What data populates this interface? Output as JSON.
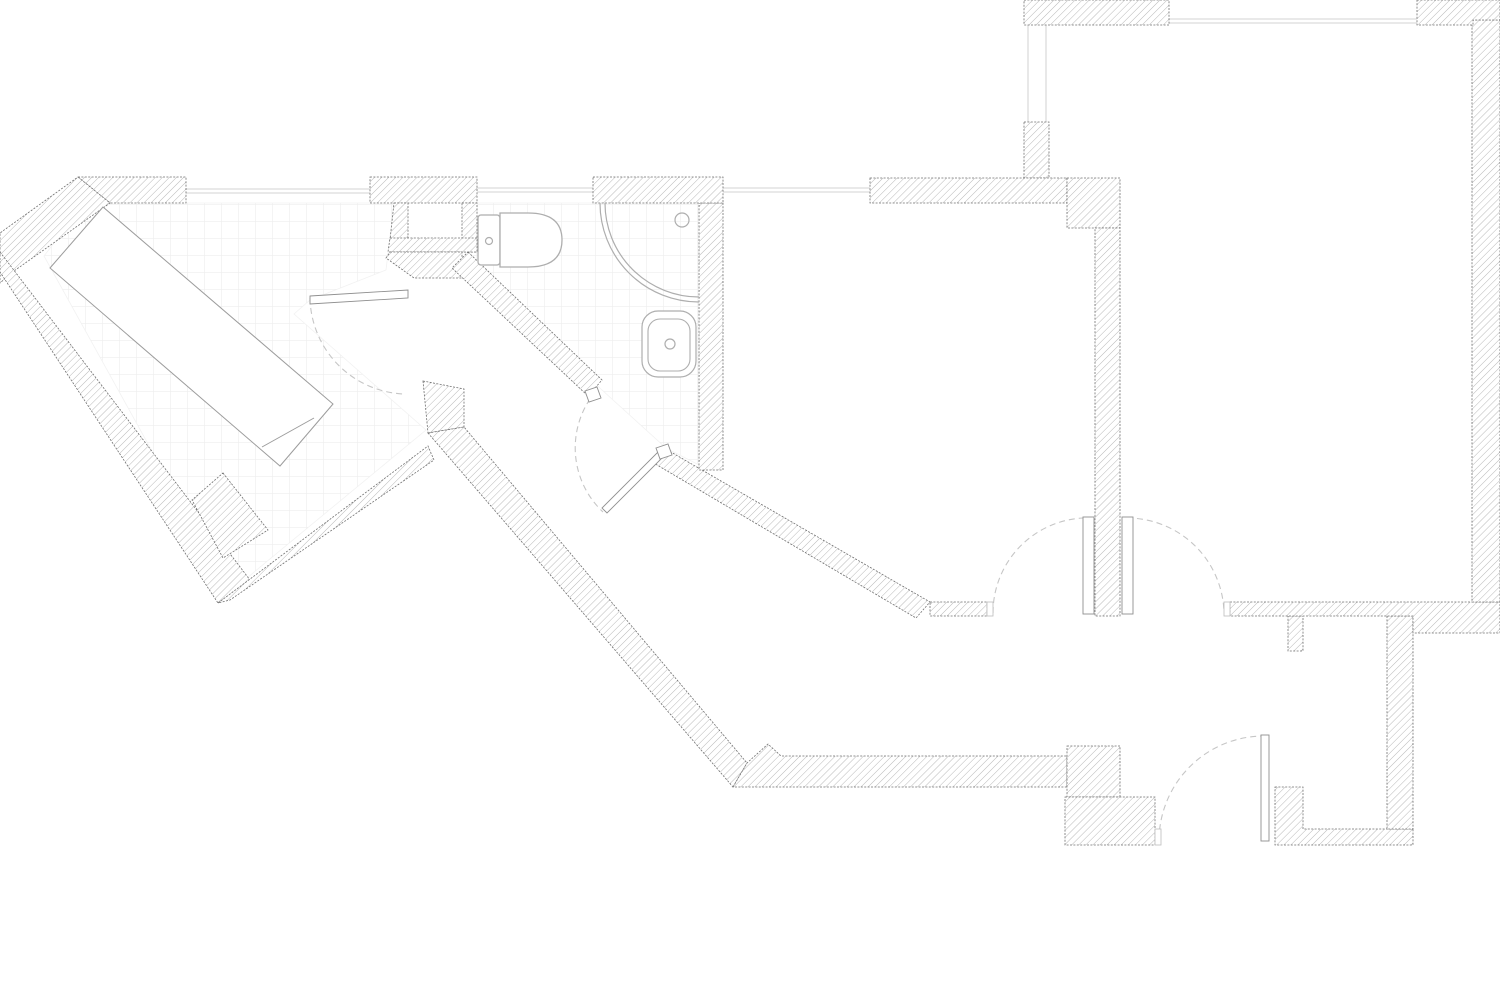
{
  "drawing": {
    "type": "architectural-floor-plan",
    "canvas": {
      "width": 1500,
      "height": 983,
      "background": "#ffffff"
    },
    "style": {
      "wall_hatch_color": "#b9b9b9",
      "wall_outline_color": "#707070",
      "tile_line_color": "#ededed",
      "tile_size": 17,
      "fixture_stroke": "#aeaeae",
      "furniture_stroke": "#9c9c9c",
      "window_color": "#e2e2e2",
      "door_arc_color": "#c6c6c6",
      "leaf_stroke": "#8f8f8f"
    },
    "tile_areas": [
      {
        "name": "entry-room-floor-tiles",
        "points": [
          [
            108,
            203
          ],
          [
            394,
            203
          ],
          [
            386,
            270
          ],
          [
            310,
            300
          ],
          [
            294,
            314
          ],
          [
            426,
            430
          ],
          [
            230,
            592
          ],
          [
            44,
            256
          ],
          [
            84,
            204
          ]
        ]
      },
      {
        "name": "bathroom-floor-tiles",
        "points": [
          [
            477,
            203
          ],
          [
            699,
            203
          ],
          [
            699,
            465
          ],
          [
            666,
            448
          ],
          [
            602,
            390
          ],
          [
            470,
            266
          ],
          [
            470,
            252
          ],
          [
            477,
            252
          ]
        ]
      }
    ],
    "walls": [
      {
        "name": "top-left-room-top-wall",
        "points": [
          [
            78,
            177
          ],
          [
            186,
            177
          ],
          [
            186,
            203
          ],
          [
            110,
            203
          ]
        ]
      },
      {
        "name": "northwest-diagonal-wall",
        "points": [
          [
            78,
            177
          ],
          [
            110,
            203
          ],
          [
            14,
            271
          ],
          [
            0,
            283
          ],
          [
            0,
            233
          ]
        ]
      },
      {
        "name": "southwest-outer-wall",
        "points": [
          [
            0,
            252
          ],
          [
            250,
            580
          ],
          [
            218,
            603
          ],
          [
            0,
            272
          ]
        ]
      },
      {
        "name": "v-notch-wall",
        "points": [
          [
            218,
            603
          ],
          [
            428,
            446
          ],
          [
            434,
            460
          ],
          [
            230,
            600
          ]
        ]
      },
      {
        "name": "corridor-door-block",
        "points": [
          [
            423,
            381
          ],
          [
            464,
            389
          ],
          [
            464,
            427
          ],
          [
            428,
            433
          ]
        ]
      },
      {
        "name": "corridor-southwest-wall",
        "points": [
          [
            428,
            433
          ],
          [
            464,
            427
          ],
          [
            747,
            763
          ],
          [
            733,
            787
          ]
        ]
      },
      {
        "name": "bottom-hall-wall",
        "points": [
          [
            733,
            787
          ],
          [
            747,
            763
          ],
          [
            768,
            744
          ],
          [
            781,
            756
          ],
          [
            1067,
            756
          ],
          [
            1067,
            787
          ]
        ]
      },
      {
        "name": "hall-step-block",
        "points": [
          [
            1067,
            746
          ],
          [
            1120,
            746
          ],
          [
            1120,
            797
          ],
          [
            1067,
            797
          ]
        ]
      },
      {
        "name": "hall-lower-block",
        "points": [
          [
            1065,
            797
          ],
          [
            1155,
            797
          ],
          [
            1155,
            845
          ],
          [
            1065,
            845
          ]
        ]
      },
      {
        "name": "entry-corner-wall",
        "points": [
          [
            1275,
            787
          ],
          [
            1303,
            787
          ],
          [
            1303,
            829
          ],
          [
            1413,
            829
          ],
          [
            1413,
            845
          ],
          [
            1275,
            845
          ]
        ]
      },
      {
        "name": "nook-right-wall",
        "points": [
          [
            1387,
            616
          ],
          [
            1413,
            616
          ],
          [
            1413,
            829
          ],
          [
            1387,
            829
          ]
        ]
      },
      {
        "name": "nook-top-stub",
        "points": [
          [
            1288,
            616
          ],
          [
            1303,
            616
          ],
          [
            1303,
            651
          ],
          [
            1288,
            651
          ]
        ]
      },
      {
        "name": "bottomright-top-wall",
        "points": [
          [
            1230,
            602
          ],
          [
            1500,
            602
          ],
          [
            1500,
            633
          ],
          [
            1413,
            633
          ],
          [
            1413,
            616
          ],
          [
            1230,
            616
          ]
        ]
      },
      {
        "name": "right-outer-wall",
        "points": [
          [
            1472,
            20
          ],
          [
            1500,
            20
          ],
          [
            1500,
            602
          ],
          [
            1472,
            602
          ]
        ]
      },
      {
        "name": "topright-corner-wall",
        "points": [
          [
            1417,
            0
          ],
          [
            1500,
            0
          ],
          [
            1500,
            20
          ],
          [
            1473,
            20
          ],
          [
            1473,
            25
          ],
          [
            1417,
            25
          ]
        ]
      },
      {
        "name": "bedroom-top-wall",
        "points": [
          [
            1024,
            0
          ],
          [
            1169,
            0
          ],
          [
            1169,
            25
          ],
          [
            1024,
            25
          ]
        ]
      },
      {
        "name": "window-stub-wall",
        "points": [
          [
            1024,
            122
          ],
          [
            1049,
            122
          ],
          [
            1049,
            178
          ],
          [
            1024,
            178
          ]
        ]
      },
      {
        "name": "living-top-wall",
        "points": [
          [
            870,
            178
          ],
          [
            1067,
            178
          ],
          [
            1067,
            203
          ],
          [
            870,
            203
          ]
        ]
      },
      {
        "name": "living-corner-block",
        "points": [
          [
            1067,
            178
          ],
          [
            1120,
            178
          ],
          [
            1120,
            228
          ],
          [
            1067,
            228
          ]
        ]
      },
      {
        "name": "room-divider-wall",
        "points": [
          [
            1095,
            228
          ],
          [
            1120,
            228
          ],
          [
            1120,
            616
          ],
          [
            1095,
            616
          ]
        ]
      },
      {
        "name": "living-bottom-wall",
        "points": [
          [
            930,
            602
          ],
          [
            987,
            602
          ],
          [
            987,
            616
          ],
          [
            930,
            616
          ]
        ]
      },
      {
        "name": "living-southwest-wall",
        "points": [
          [
            664,
            448
          ],
          [
            930,
            602
          ],
          [
            916,
            618
          ],
          [
            652,
            462
          ]
        ]
      },
      {
        "name": "bathroom-right-wall",
        "points": [
          [
            699,
            203
          ],
          [
            723,
            203
          ],
          [
            723,
            470
          ],
          [
            699,
            470
          ]
        ]
      },
      {
        "name": "bathroom-top-wall",
        "points": [
          [
            593,
            177
          ],
          [
            723,
            177
          ],
          [
            723,
            203
          ],
          [
            593,
            203
          ]
        ]
      },
      {
        "name": "middle-top-wall",
        "points": [
          [
            370,
            177
          ],
          [
            477,
            177
          ],
          [
            477,
            203
          ],
          [
            370,
            203
          ]
        ]
      },
      {
        "name": "niche-left-wall",
        "points": [
          [
            394,
            203
          ],
          [
            408,
            203
          ],
          [
            408,
            240
          ],
          [
            390,
            240
          ]
        ]
      },
      {
        "name": "niche-right-wall",
        "points": [
          [
            462,
            203
          ],
          [
            477,
            203
          ],
          [
            477,
            252
          ],
          [
            462,
            252
          ]
        ]
      },
      {
        "name": "niche-bottom-wall",
        "points": [
          [
            390,
            238
          ],
          [
            477,
            238
          ],
          [
            477,
            252
          ],
          [
            388,
            252
          ]
        ]
      },
      {
        "name": "under-niche-wall",
        "points": [
          [
            390,
            252
          ],
          [
            462,
            252
          ],
          [
            462,
            278
          ],
          [
            414,
            278
          ],
          [
            386,
            258
          ]
        ]
      },
      {
        "name": "bathroom-southwest-wall",
        "points": [
          [
            468,
            252
          ],
          [
            602,
            380
          ],
          [
            588,
            396
          ],
          [
            452,
            268
          ]
        ]
      },
      {
        "name": "room-corner-block",
        "points": [
          [
            223,
            473
          ],
          [
            268,
            530
          ],
          [
            223,
            558
          ],
          [
            192,
            500
          ]
        ]
      }
    ],
    "furniture": [
      {
        "name": "wardrobe",
        "points": [
          [
            103,
            207
          ],
          [
            333,
            404
          ],
          [
            280,
            466
          ],
          [
            50,
            268
          ]
        ],
        "divider": [
          [
            262,
            447
          ],
          [
            314,
            418
          ]
        ]
      }
    ],
    "door_caps": [
      {
        "name": "bathroom-door-cap-left",
        "points": [
          [
            585,
            391
          ],
          [
            597,
            387
          ],
          [
            601,
            398
          ],
          [
            589,
            402
          ]
        ]
      },
      {
        "name": "bathroom-door-cap-right",
        "points": [
          [
            656,
            448
          ],
          [
            668,
            444
          ],
          [
            672,
            455
          ],
          [
            660,
            459
          ]
        ]
      }
    ],
    "jambs": [
      {
        "name": "living-door-jamb",
        "rect": [
          987,
          602,
          6,
          14
        ]
      },
      {
        "name": "bedroom-door-jamb",
        "rect": [
          1224,
          602,
          6,
          14
        ]
      },
      {
        "name": "entry-door-jamb",
        "rect": [
          1155,
          829,
          6,
          16
        ]
      }
    ],
    "doors": [
      {
        "name": "tiled-room-door",
        "leaf_points": [
          [
            310,
            296
          ],
          [
            408,
            290
          ],
          [
            408,
            298
          ],
          [
            310,
            304
          ]
        ],
        "arc": "M310,298 A98,98 0 0 0 404,394"
      },
      {
        "name": "bathroom-door",
        "leaf_points": [
          [
            660,
            450
          ],
          [
            665,
            455
          ],
          [
            607,
            513
          ],
          [
            602,
            508
          ]
        ],
        "arc": "M590,399 A88,88 0 0 0 603,512"
      },
      {
        "name": "living-room-door",
        "leaf_rect": [
          1083,
          517,
          11,
          97
        ],
        "arc": "M993,613 A95,95 0 0 1 1083,518"
      },
      {
        "name": "bedroom-door",
        "leaf_rect": [
          1122,
          517,
          11,
          97
        ],
        "arc": "M1127,518 A97,97 0 0 1 1224,612"
      },
      {
        "name": "entry-door",
        "leaf_rect": [
          1261,
          735,
          8,
          106
        ],
        "arc": "M1159,840 A105,105 0 0 1 1264,736"
      }
    ],
    "windows": [
      {
        "name": "tiled-room-window",
        "lines": [
          [
            186,
            189,
            370,
            189
          ],
          [
            186,
            193,
            370,
            193
          ]
        ]
      },
      {
        "name": "bathroom-window",
        "lines": [
          [
            477,
            188,
            593,
            188
          ],
          [
            477,
            192,
            593,
            192
          ]
        ]
      },
      {
        "name": "living-room-window",
        "lines": [
          [
            723,
            188,
            870,
            188
          ],
          [
            723,
            192,
            870,
            192
          ]
        ]
      },
      {
        "name": "bedroom-top-window",
        "lines": [
          [
            1169,
            19,
            1417,
            19
          ],
          [
            1169,
            23,
            1417,
            23
          ]
        ]
      },
      {
        "name": "bedroom-side-window",
        "lines": [
          [
            1028,
            25,
            1028,
            122
          ],
          [
            1046,
            25,
            1046,
            122
          ]
        ]
      }
    ],
    "fixtures": {
      "toilet": {
        "name": "toilet",
        "tank": [
          478,
          215,
          22,
          50
        ],
        "bowl_path": "M500,213 h28 q34,0 34,27 q0,27 -34,27 h-28 z",
        "button": [
          489,
          241,
          3.5
        ]
      },
      "shower": {
        "name": "corner-shower",
        "center": [
          699,
          203
        ],
        "r_outer": 99,
        "r_inner": 94,
        "arc_outer": "M600,203 A99,99 0 0 0 699,302",
        "arc_inner": "M605,203 A94,94 0 0 0 699,297",
        "head": [
          682,
          220,
          7
        ]
      },
      "sink": {
        "name": "sink",
        "outer": [
          642,
          311,
          54,
          66,
          16
        ],
        "inner": [
          648,
          319,
          42,
          52,
          12
        ],
        "tap": [
          670,
          344,
          5
        ]
      }
    }
  }
}
